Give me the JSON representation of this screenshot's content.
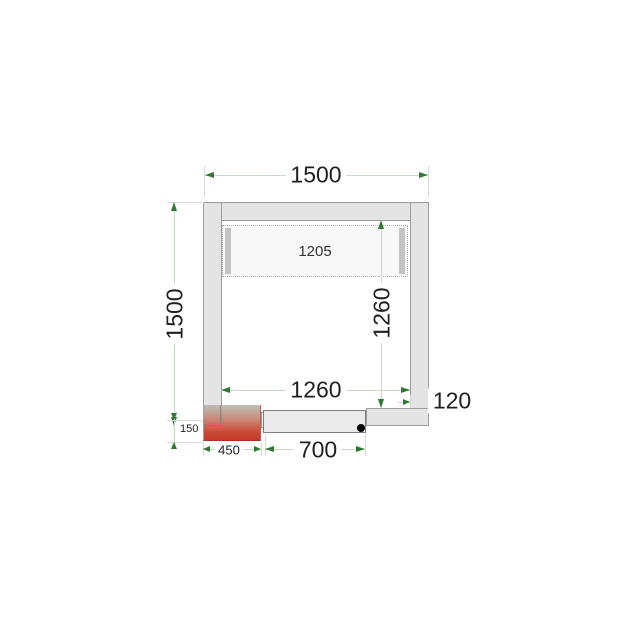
{
  "diagram": {
    "title": "cold-room-floor-plan",
    "dimensions": {
      "outer_width": "1500",
      "outer_depth": "1500",
      "inner_width": "1260",
      "inner_depth": "1260",
      "ceiling_panel_width": "1205",
      "wall_thickness": "120",
      "unit_overhang": "150",
      "unit_width": "450",
      "door_width": "700"
    },
    "colors": {
      "wall_fill": "#e4e4e4",
      "wall_border": "#9b9b9b",
      "dimension_line": "#c9d9c9",
      "extension_line": "#dadada",
      "arrow_green": "#2c7a2e",
      "text": "#1f1f1f",
      "unit_gradient_top": "#b2b8b0",
      "unit_gradient_bottom": "#c23a28",
      "hinge_dot": "#000000"
    }
  }
}
